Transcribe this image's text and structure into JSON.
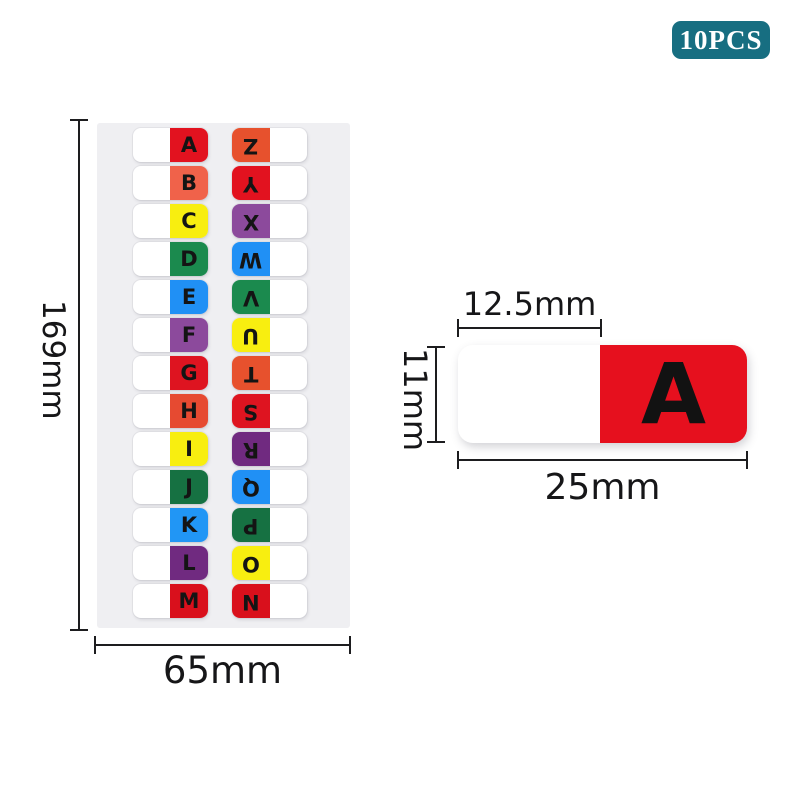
{
  "badge": {
    "label": "10PCS",
    "bg_color": "#176e81"
  },
  "sheet": {
    "bg_color": "#efeff2",
    "height_label": "169mm",
    "width_label": "65mm",
    "rows": [
      {
        "left": {
          "letter": "A",
          "color": "#e2121f"
        },
        "right": {
          "letter": "Z",
          "color": "#e7512d"
        }
      },
      {
        "left": {
          "letter": "B",
          "color": "#f0624a"
        },
        "right": {
          "letter": "Y",
          "color": "#e2121f"
        }
      },
      {
        "left": {
          "letter": "C",
          "color": "#f8ee10"
        },
        "right": {
          "letter": "X",
          "color": "#8c4a9c"
        }
      },
      {
        "left": {
          "letter": "D",
          "color": "#1b8a4e"
        },
        "right": {
          "letter": "W",
          "color": "#2090f5"
        }
      },
      {
        "left": {
          "letter": "E",
          "color": "#2090f5"
        },
        "right": {
          "letter": "V",
          "color": "#1b8a4e"
        }
      },
      {
        "left": {
          "letter": "F",
          "color": "#8c4a9c"
        },
        "right": {
          "letter": "U",
          "color": "#f8ee10"
        }
      },
      {
        "left": {
          "letter": "G",
          "color": "#de1420"
        },
        "right": {
          "letter": "T",
          "color": "#e7512d"
        }
      },
      {
        "left": {
          "letter": "H",
          "color": "#e64a31"
        },
        "right": {
          "letter": "S",
          "color": "#de1420"
        }
      },
      {
        "left": {
          "letter": "I",
          "color": "#f8ee10"
        },
        "right": {
          "letter": "R",
          "color": "#702a80"
        }
      },
      {
        "left": {
          "letter": "J",
          "color": "#167142"
        },
        "right": {
          "letter": "Q",
          "color": "#2090f5"
        }
      },
      {
        "left": {
          "letter": "K",
          "color": "#2196f5"
        },
        "right": {
          "letter": "P",
          "color": "#167142"
        }
      },
      {
        "left": {
          "letter": "L",
          "color": "#702a80"
        },
        "right": {
          "letter": "O",
          "color": "#f8ee10"
        }
      },
      {
        "left": {
          "letter": "M",
          "color": "#d9101c"
        },
        "right": {
          "letter": "N",
          "color": "#d9101c"
        }
      }
    ]
  },
  "tab_detail": {
    "letter": "A",
    "color": "#e6101e",
    "top_width_label": "12.5mm",
    "height_label": "11mm",
    "width_label": "25mm"
  }
}
